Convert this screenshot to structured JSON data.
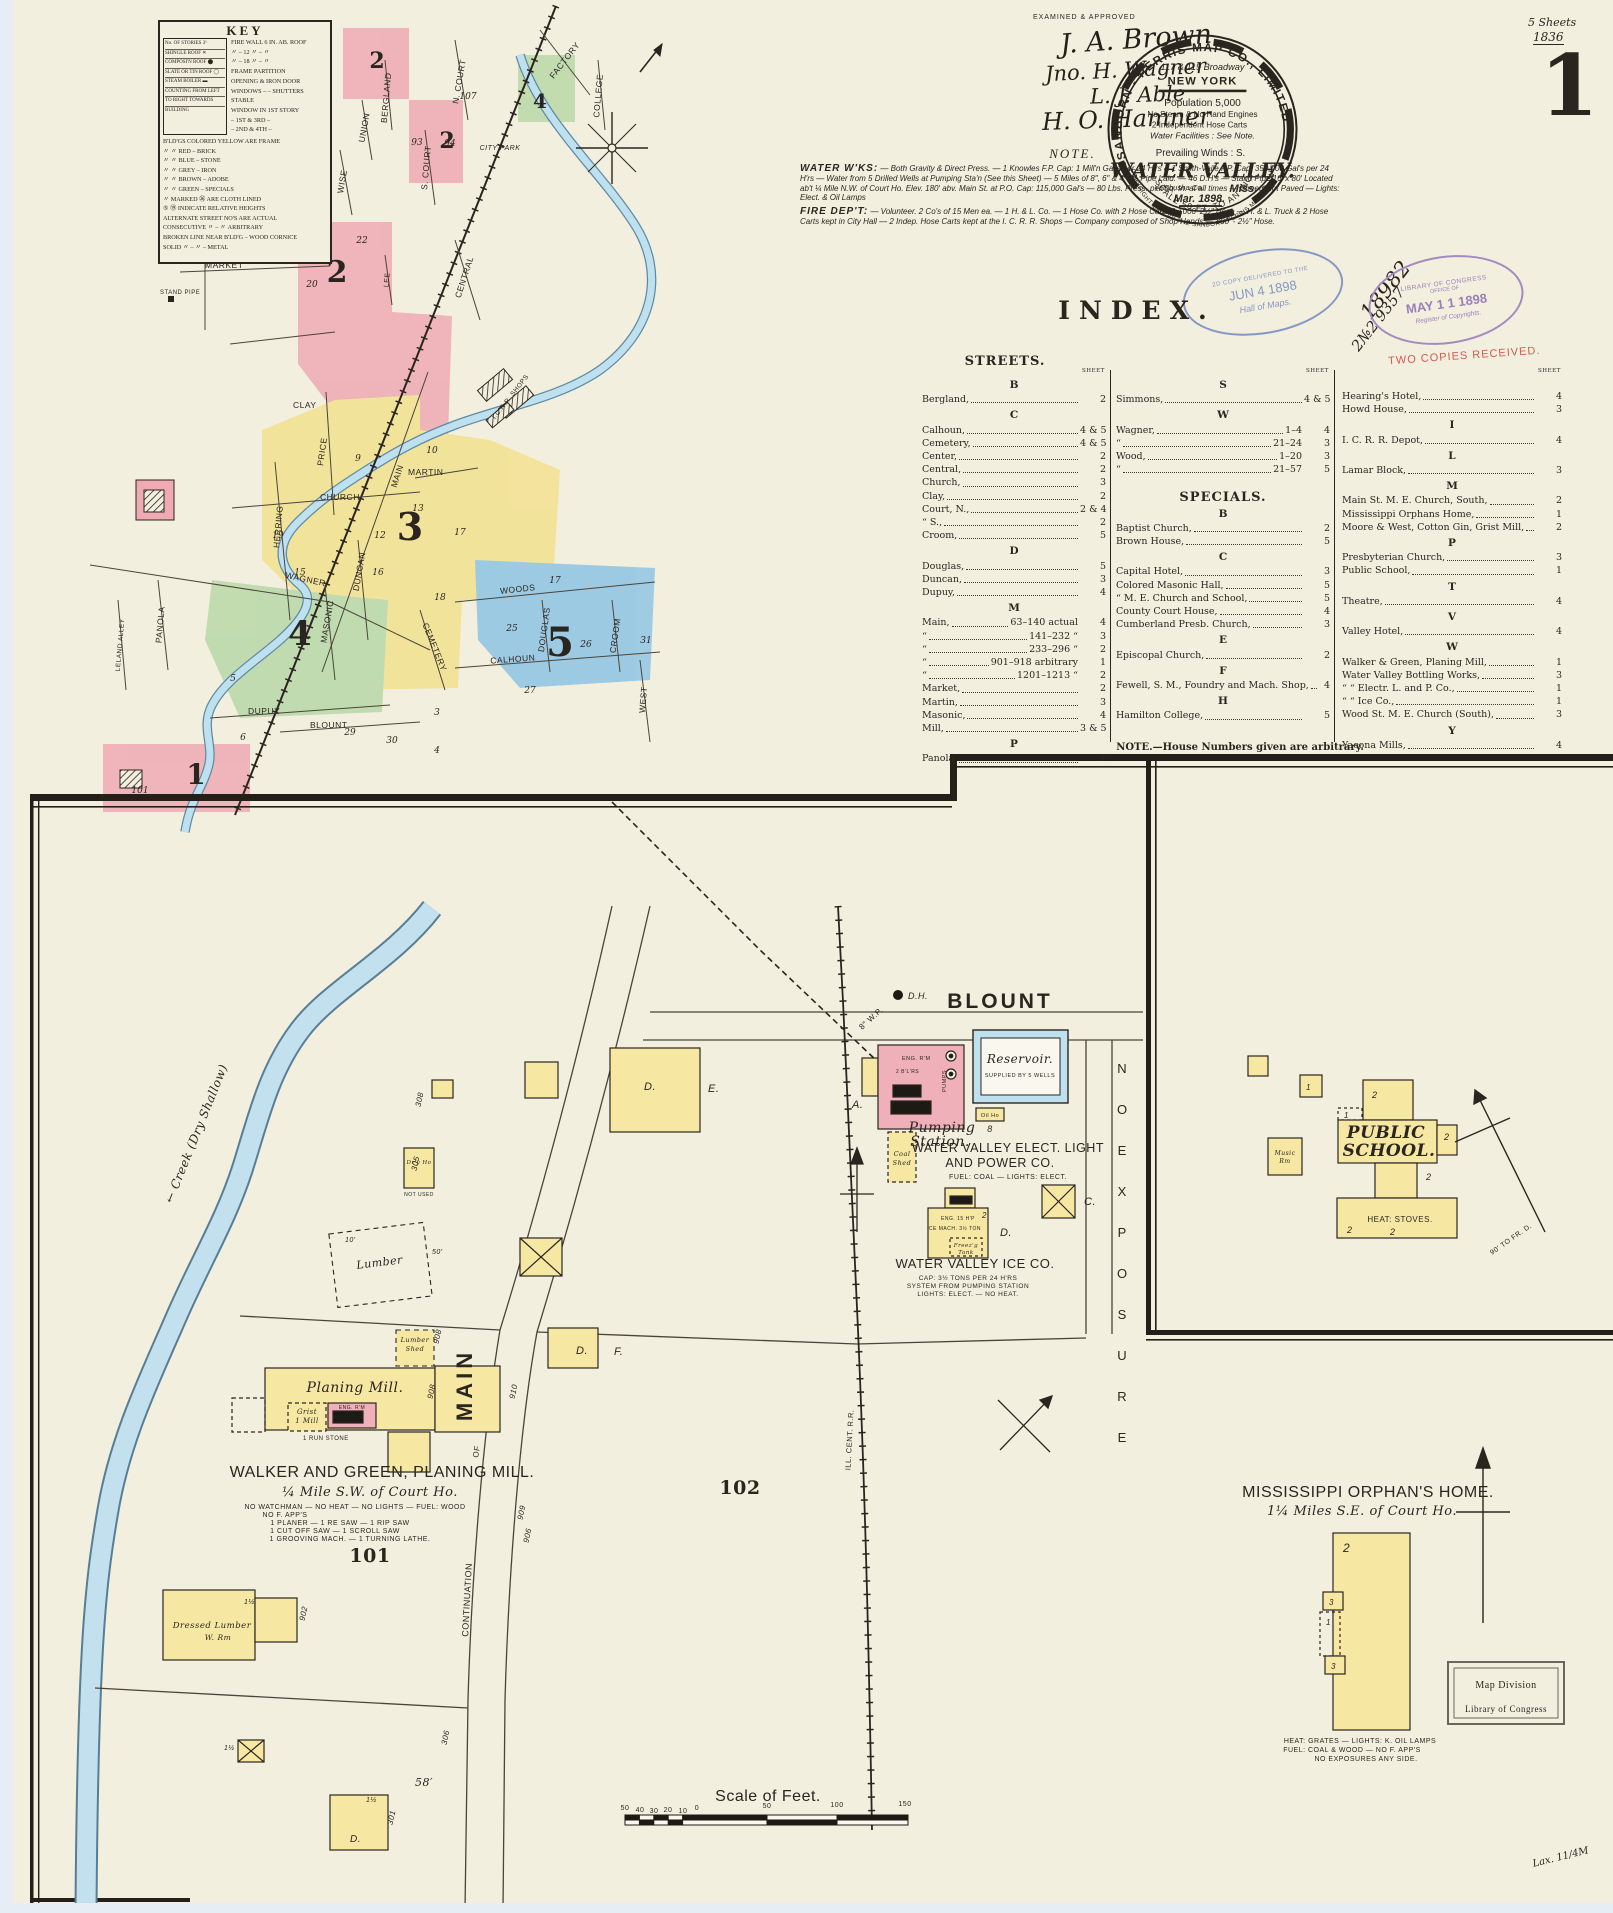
{
  "page": {
    "sheet_big_number": "1",
    "sheets_count": "5 Sheets",
    "sheets_year": "1836",
    "examined": "EXAMINED & APPROVED",
    "lax_note": "Lax. 11/4M"
  },
  "signatures": [
    "J. A. Brown",
    "Jno. H. Wagner",
    "L. J. Able",
    "H. O. Hamner"
  ],
  "logo": {
    "company_arc": "SANBORN - PERRIS  MAP  CO.,  LIMITED",
    "address": "117 & 119 Broadway",
    "city": "NEW YORK",
    "population": "Population 5,000",
    "engines": "No Steam & No Hand Engines",
    "hose_carts": "2 Independent Hose Carts",
    "water": "Water Facilities : See Note.",
    "winds": "Prevailing Winds : S.",
    "title": "WATER VALLEY.",
    "state": "Miss.",
    "county": "Yalobusha Co.",
    "date": "Mar. 1898.",
    "scale_arc": "SCALE  50 FT. TO AN  INCH",
    "copyright_arc": "COPYRIGHT 1898 BY THE SANBORN-PERRIS MAP CO. LIMITED"
  },
  "stamps": {
    "jun_line1": "2D COPY DELIVERED TO THE",
    "jun_line2": "JUN 4 1898",
    "jun_line3": "Hall of Maps.",
    "may_line1": "LIBRARY OF CONGRESS",
    "may_line2": "OFFICE OF",
    "may_line3": "MAY 1 1 1898",
    "may_line4": "Register of Copyrights.",
    "two_copies": "TWO COPIES RECEIVED.",
    "hand1": "18982",
    "hand2": "2№2 9357"
  },
  "note": {
    "title": "NOTE.",
    "water_heading": "WATER W'KS:",
    "water_text": "— Both Gravity & Direct Press. — 1 Knowles F.P. Cap: 1 Mill'n Gal's per 24 H'rs & 1 Smith-Vaile F.P. Cap: 350,000 Gal's per 24 H'rs — Water from 5 Drilled Wells at Pumping Sta'n (See this Sheet) — 5 Miles of 8″, 6″ & 4″ W. Pipe Laid. — 46 D.H's — Stand Pipe 16′ x 80′ Located ab't ¼ Mile N.W. of Court Ho. Elev. 180′ abv. Main St. at P.O. Cap: 115,000 Gal's — 80 Lbs. Press. per Sq. In. at all times — Streets not Paved — Lights: Elect. & Oil Lamps",
    "fire_heading": "FIRE DEP'T:",
    "fire_text": "— Volunteer.  2 Co's of 15 Men ea. — 1 H. & L. Co. — 1 Hose Co. with 2 Hose Carts & 1000′ 2½″ Hose — H. & L. Truck & 2 Hose Carts kept in City Hall — 2 Indep. Hose Carts kept at the I. C. R. R. Shops — Company composed of Shop Hands — 800′ - 2½″ Hose."
  },
  "key": {
    "title": "KEY",
    "left_rows": [
      "No. OF STORIES 3¹",
      "SHINGLE ROOF ✕",
      "COMPOSI'N ROOF ⬤",
      "SLATE OR TIN ROOF ◯",
      "STEAM BOILER ▬",
      "COUNTING FROM LEFT",
      "TO RIGHT TOWARDS",
      "BUILDING"
    ],
    "rows": [
      "Fire Wall 6 in. ab. Roof",
      "〃   –   12 〃   –   〃",
      "〃   –   18 〃   –   〃",
      "Frame Partition",
      "Opening & Iron Door",
      "Windows – – Shutters",
      "Stable",
      "Window in 1st Story",
      "–   1st & 3rd   –",
      "–   2nd & 4th   –"
    ],
    "color_rows": [
      "B'ld'gs colored YELLOW are FRAME",
      "〃   〃   RED  –  BRICK",
      "〃   〃   BLUE  –  STONE",
      "〃   〃   GREY  –  IRON",
      "〃   〃   BROWN  –  ADOBE",
      "〃   〃   GREEN  –  SPECIALS"
    ],
    "note_rows": [
      "〃 marked ㉖ are CLOTH LINED",
      "⑤ ⑲ indicate RELATIVE HEIGHTS",
      "Alternate Street No's are ACTUAL",
      "CONSECUTIVE  〃   –   〃  ARBITRARY",
      "Broken line near B'ld'g – WOOD CORNICE",
      "SOLID   〃   –   〃   –   METAL"
    ]
  },
  "index": {
    "title": "INDEX.",
    "streets_heading": "STREETS.",
    "specials_heading": "SPECIALS.",
    "sheet_label": "SHEET",
    "footnote": "NOTE.—House Numbers given are arbitrary.",
    "col1": [
      {
        "letter": "B",
        "entries": [
          {
            "n": "Bergland,",
            "s": "2"
          }
        ]
      },
      {
        "letter": "C",
        "entries": [
          {
            "n": "Calhoun,",
            "s": "4 & 5"
          },
          {
            "n": "Cemetery,",
            "s": "4 & 5"
          },
          {
            "n": "Center,",
            "s": "2"
          },
          {
            "n": "Central,",
            "s": "2"
          },
          {
            "n": "Church,",
            "s": "3"
          },
          {
            "n": "Clay,",
            "s": "2"
          },
          {
            "n": "Court, N.,",
            "s": "2 & 4"
          },
          {
            "n": "“    S.,",
            "s": "2"
          },
          {
            "n": "Croom,",
            "s": "5"
          }
        ]
      },
      {
        "letter": "D",
        "entries": [
          {
            "n": "Douglas,",
            "s": "5"
          },
          {
            "n": "Duncan,",
            "s": "3"
          },
          {
            "n": "Dupuy,",
            "s": "4"
          }
        ]
      },
      {
        "letter": "M",
        "entries": [
          {
            "n": "Main,",
            "m": "63–140 actual",
            "s": "4"
          },
          {
            "n": "“",
            "m": "141–232   “",
            "s": "3"
          },
          {
            "n": "“",
            "m": "233–296   “",
            "s": "2"
          },
          {
            "n": "“",
            "m": "901–918 arbitrary",
            "s": "1"
          },
          {
            "n": "“",
            "m": "1201–1213   “",
            "s": "2"
          },
          {
            "n": "Market,",
            "s": "2"
          },
          {
            "n": "Martin,",
            "s": "3"
          },
          {
            "n": "Masonic,",
            "s": "4"
          },
          {
            "n": "Mill,",
            "s": "3 & 5"
          }
        ]
      },
      {
        "letter": "P",
        "entries": [
          {
            "n": "Panola,",
            "s": "4"
          }
        ]
      }
    ],
    "col2_streets": [
      {
        "letter": "S",
        "entries": [
          {
            "n": "Simmons,",
            "s": "4 & 5"
          }
        ]
      },
      {
        "letter": "W",
        "entries": [
          {
            "n": "Wagner,",
            "m": "1–4",
            "s": "4"
          },
          {
            "n": "“",
            "m": "21–24",
            "s": "3"
          },
          {
            "n": "Wood,",
            "m": "1–20",
            "s": "3"
          },
          {
            "n": "“",
            "m": "21–57",
            "s": "5"
          }
        ]
      }
    ],
    "col2_specials": [
      {
        "letter": "B",
        "entries": [
          {
            "n": "Baptist Church,",
            "s": "2"
          },
          {
            "n": "Brown House,",
            "s": "5"
          }
        ]
      },
      {
        "letter": "C",
        "entries": [
          {
            "n": "Capital Hotel,",
            "s": "3"
          },
          {
            "n": "Colored Masonic Hall,",
            "s": "5"
          },
          {
            "n": "“   M. E. Church and School,",
            "s": "5"
          },
          {
            "n": "County Court House,",
            "s": "4"
          },
          {
            "n": "Cumberland Presb. Church,",
            "s": "3"
          }
        ]
      },
      {
        "letter": "E",
        "entries": [
          {
            "n": "Episcopal Church,",
            "s": "2"
          }
        ]
      },
      {
        "letter": "F",
        "entries": [
          {
            "n": "Fewell, S. M., Foundry and Mach. Shop,",
            "s": "4"
          }
        ]
      },
      {
        "letter": "H",
        "entries": [
          {
            "n": "Hamilton College,",
            "s": "5"
          }
        ]
      }
    ],
    "col3": [
      {
        "letter": "",
        "entries": [
          {
            "n": "Hearing's Hotel,",
            "s": "4"
          },
          {
            "n": "Howd House,",
            "s": "3"
          }
        ]
      },
      {
        "letter": "I",
        "entries": [
          {
            "n": "I. C. R. R. Depot,",
            "s": "4"
          }
        ]
      },
      {
        "letter": "L",
        "entries": [
          {
            "n": "Lamar Block,",
            "s": "3"
          }
        ]
      },
      {
        "letter": "M",
        "entries": [
          {
            "n": "Main St. M. E. Church, South,",
            "s": "2"
          },
          {
            "n": "Mississippi Orphans Home,",
            "s": "1"
          },
          {
            "n": "Moore & West, Cotton Gin, Grist Mill,",
            "s": "2"
          }
        ]
      },
      {
        "letter": "P",
        "entries": [
          {
            "n": "Presbyterian Church,",
            "s": "3"
          },
          {
            "n": "Public School,",
            "s": "1"
          }
        ]
      },
      {
        "letter": "T",
        "entries": [
          {
            "n": "Theatre,",
            "s": "4"
          }
        ]
      },
      {
        "letter": "V",
        "entries": [
          {
            "n": "Valley Hotel,",
            "s": "4"
          }
        ]
      },
      {
        "letter": "W",
        "entries": [
          {
            "n": "Walker & Green, Planing Mill,",
            "s": "1"
          },
          {
            "n": "Water Valley Bottling Works,",
            "s": "3"
          },
          {
            "n": "“    “    Electr. L. and P. Co.,",
            "s": "1"
          },
          {
            "n": "“    “    Ice Co.,",
            "s": "1"
          },
          {
            "n": "Wood St. M. E. Church (South),",
            "s": "3"
          }
        ]
      },
      {
        "letter": "Y",
        "entries": [
          {
            "n": "Yacona Mills,",
            "s": "4"
          }
        ]
      }
    ]
  },
  "ov": {
    "streets": [
      "MARKET",
      "CLAY",
      "PRICE",
      "CHURCH",
      "MAIN",
      "MARTIN",
      "HERRING",
      "WAGNER",
      "DUNCAN",
      "MASONIC",
      "WOODS",
      "DOUGLAS",
      "CALHOUN",
      "CROOM",
      "CEMETERY",
      "PANOLA",
      "LELAND ALLEY",
      "DUPUY",
      "BLOUNT",
      "WEST",
      "FACTORY",
      "COLLEGE",
      "S. COURT",
      "N. COURT",
      "BERGLAND",
      "WISE",
      "ROBINSON",
      "UNION",
      "CENTRAL",
      "LEE",
      "CITY PARK",
      "I.C.R.R. SHOPS",
      "STAND PIPE"
    ],
    "districts": [
      "1",
      "2",
      "2",
      "2",
      "3",
      "4",
      "4",
      "5"
    ],
    "blocks": [
      "9",
      "10",
      "13",
      "12",
      "19",
      "15",
      "16",
      "17",
      "18",
      "17",
      "25",
      "26",
      "31",
      "27",
      "21",
      "22",
      "20",
      "29",
      "30",
      "3",
      "4",
      "5",
      "6",
      "106",
      "107",
      "93",
      "94",
      "101"
    ]
  },
  "dm": {
    "blount": "BLOUNT",
    "dh": "D.H.",
    "wp": "8″ W.P.",
    "a_label": "A.",
    "eng_rm": "ENG. R'M",
    "boilers": "2 B'L'RS",
    "pumps": "PUMPS",
    "pump_label1": "Pumping",
    "pump_label2": "Station.",
    "elp1": "WATER VALLEY ELECT. LIGHT",
    "elp2": "AND POWER CO.",
    "elp3": "FUEL: COAL — LIGHTS: ELECT.",
    "coal_shed1": "Coal",
    "coal_shed2": "Shed",
    "oil_ho": "Oil Ho",
    "reservoir": "Reservoir.",
    "reservoir_sub": "SUPPLIED BY 5 WELLS",
    "ice_eng": "ENG. 15 H'P",
    "ice_mach": "ICE MACH. 3½ TON",
    "freez1": "Freez'g",
    "freez2": "Tank",
    "ice_title": "WATER VALLEY ICE CO.",
    "ice_cap": "CAP: 3½ TONS PER 24 H'RS",
    "ice_sys": "SYSTEM FROM PUMPING STATION",
    "ice_lights": "LIGHTS: ELECT. — NO HEAT.",
    "c_label": "C.",
    "d_label": "D.",
    "e_label": "E.",
    "f_label": "F.",
    "no_exposure": "N O E X P O S U R E",
    "creek": "← Creek  (Dry Shallow)",
    "dry_ho1": "Dr'y Ho",
    "dry_ho2": "NOT USED",
    "lumber": "Lumber",
    "lumber_shed1": "Lumber",
    "lumber_shed2": "Shed",
    "planing": "Planing  Mill.",
    "grist1": "Grist",
    "grist2": "1 Mill",
    "run_stone": "1 RUN STONE",
    "main_street": "MAIN",
    "continuation": "CONTINUATION",
    "of_word": "OF",
    "walker1": "WALKER AND GREEN, PLANING MILL.",
    "walker2": "¼ Mile S.W. of Court Ho.",
    "walker3": "NO WATCHMAN — NO HEAT — NO LIGHTS — FUEL: WOOD",
    "walker4": "NO F. APP'S",
    "walker5": "1 PLANER — 1 RE SAW — 1 RIP SAW",
    "walker6": "1 CUT OFF SAW — 1 SCROLL SAW",
    "walker7": "1 GROOVING MACH. — 1 TURNING LATHE.",
    "b101": "101",
    "b102": "102",
    "rr": "ILL. CENT. R.R.",
    "school_title1": "PUBLIC",
    "school_title2": "SCHOOL.",
    "school_heat": "HEAT: STOVES.",
    "music1": "Music",
    "music2": "Rm",
    "school_note": "90′ TO FR. D.",
    "orphan_title": "MISSISSIPPI ORPHAN'S HOME.",
    "orphan_sub": "1¼ Miles S.E. of Court Ho.",
    "orphan_n1": "HEAT: GRATES — LIGHTS: K. OIL LAMPS",
    "orphan_n2": "FUEL: COAL & WOOD — NO F. APP'S",
    "orphan_n3": "NO EXPOSURES ANY SIDE.",
    "mapdiv1": "Map Division",
    "mapdiv2": "Library of Congress",
    "dressed1": "Dressed Lumber",
    "dressed2": "W. Rm",
    "scale_title": "Scale of Feet.",
    "scale_ticks": [
      "50",
      "40",
      "30",
      "20",
      "10",
      "0",
      "50",
      "100",
      "150"
    ],
    "street_numbers": {
      "s908a": "908",
      "s908b": "908",
      "s910": "910",
      "s909": "909",
      "s906": "906",
      "s902": "902",
      "s301": "301",
      "s306": "306",
      "s308": "308",
      "s305": "305"
    },
    "measures": {
      "m58": "58′",
      "m50": "50′",
      "m10": "10′"
    }
  },
  "floors": {
    "f1": "1",
    "f1h": "1½",
    "f2": "2",
    "f3": "3",
    "f7": "7",
    "f8": "8"
  }
}
